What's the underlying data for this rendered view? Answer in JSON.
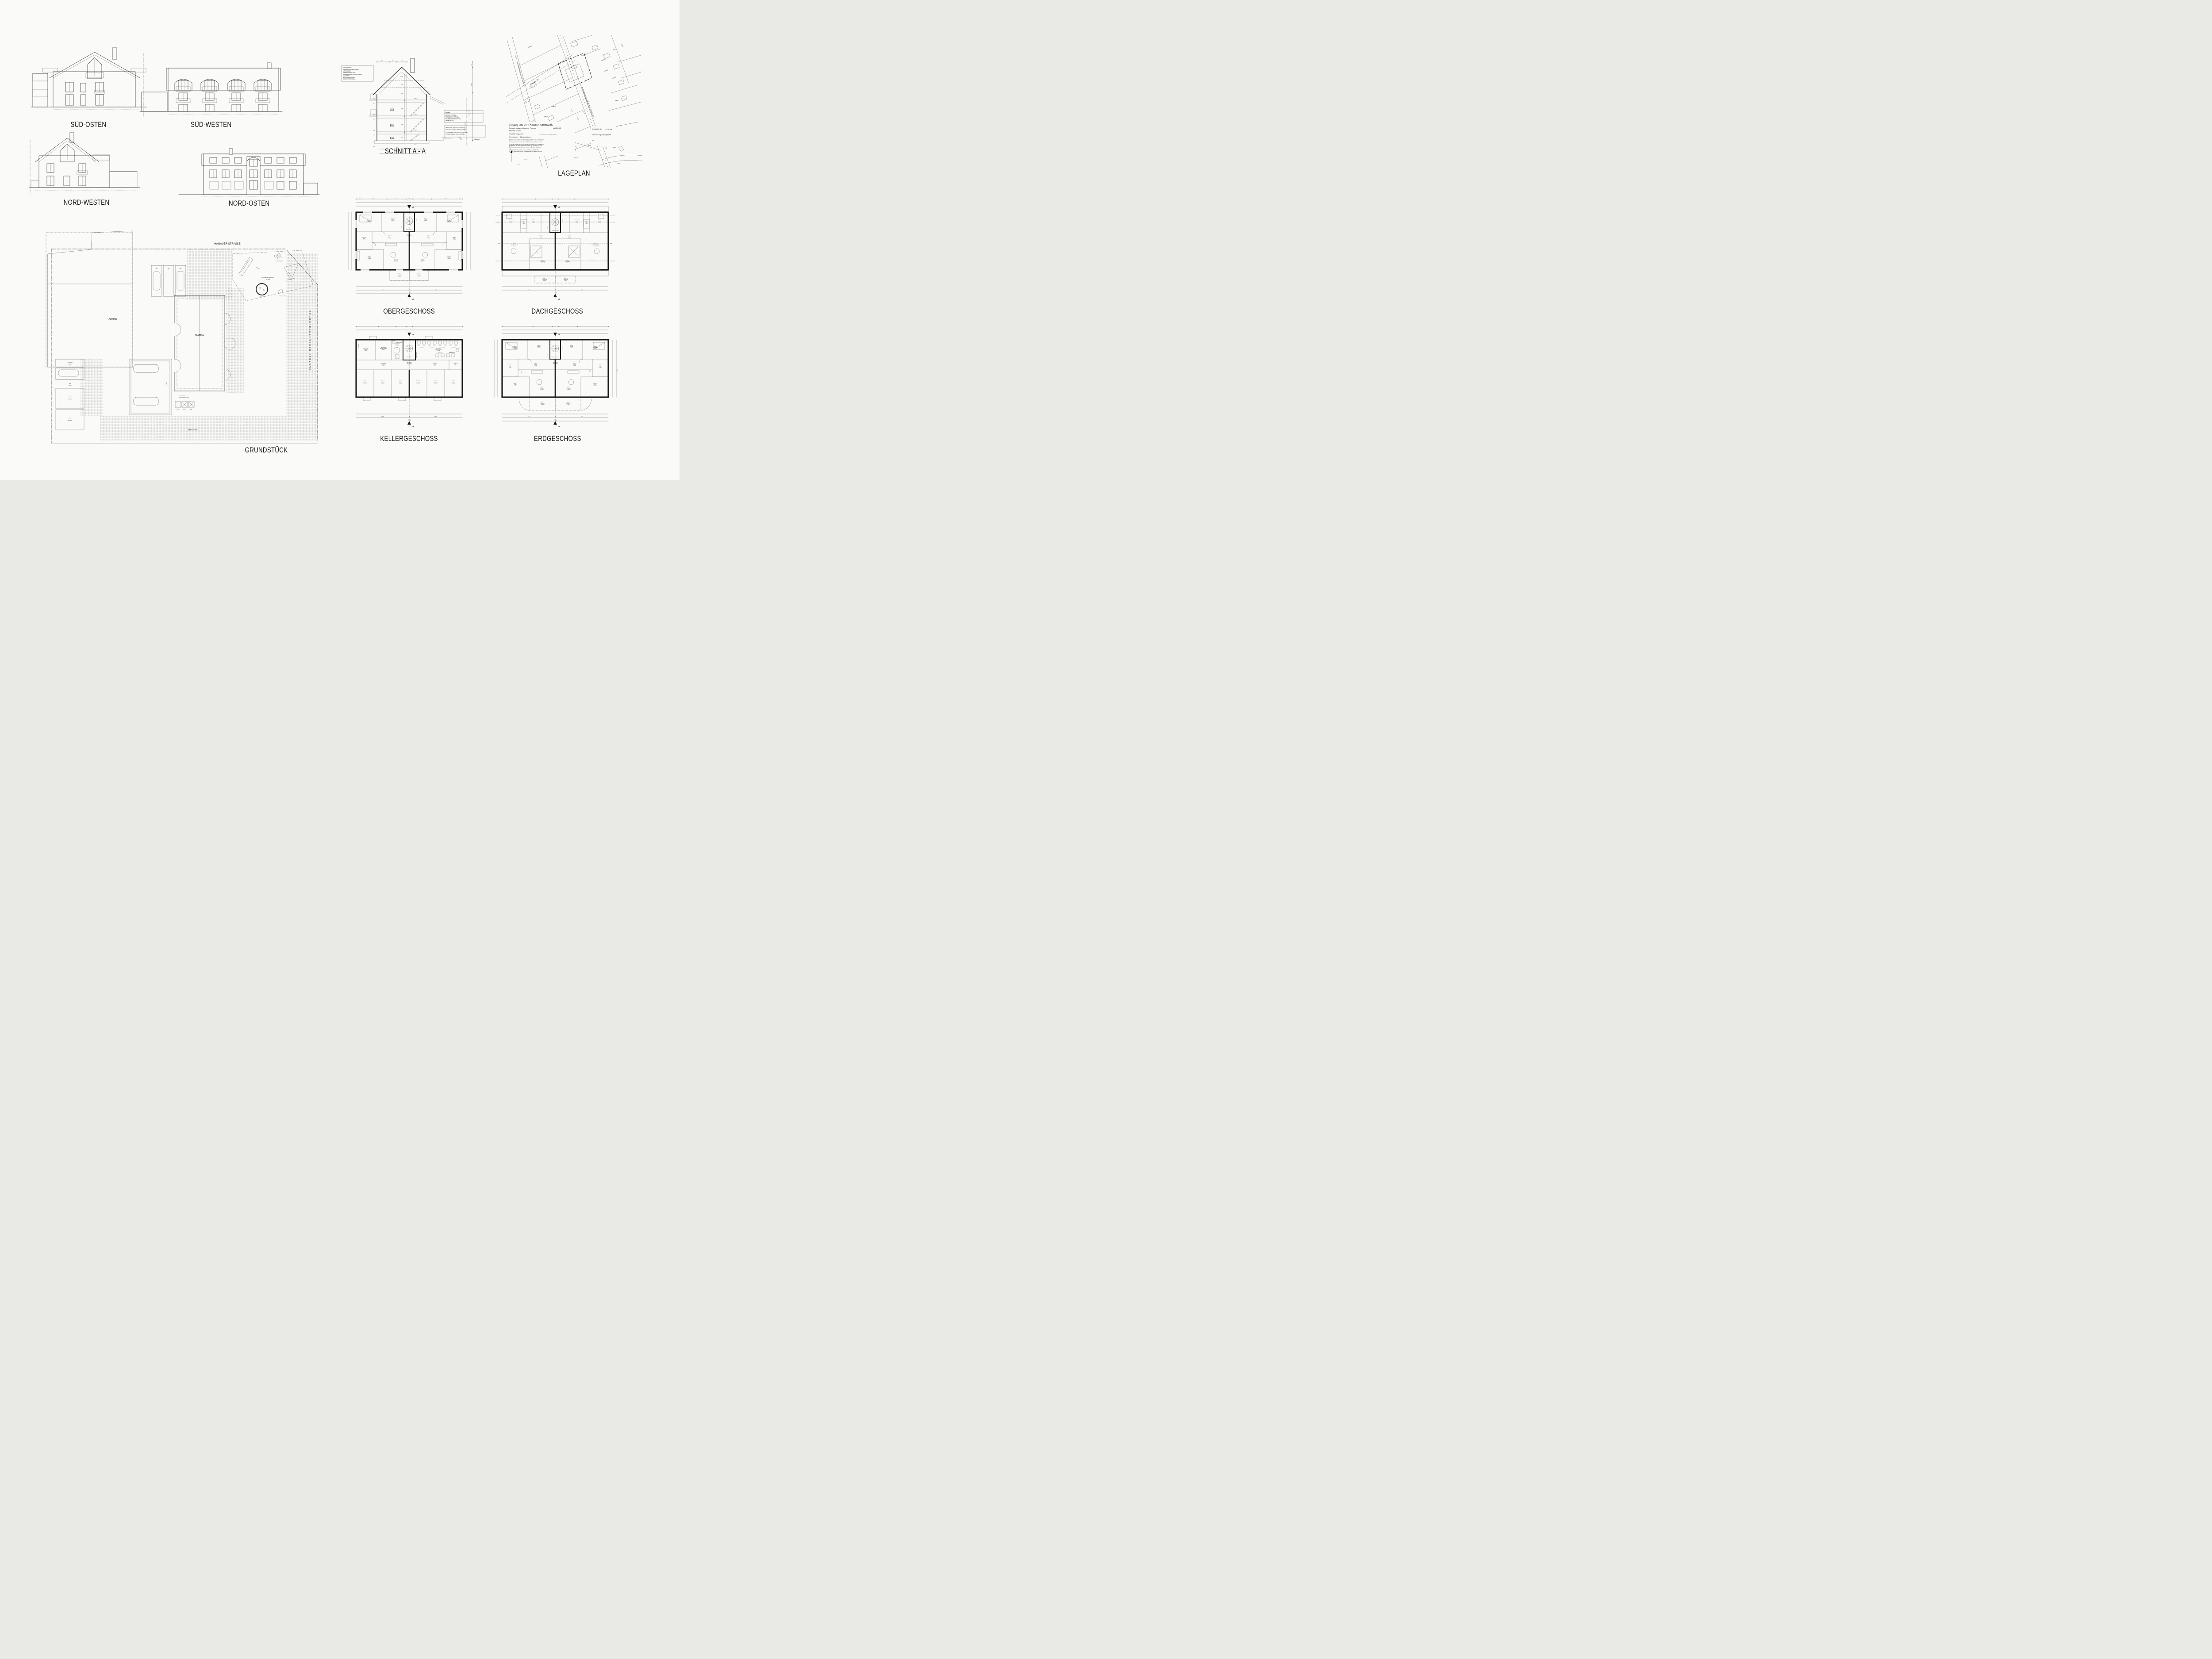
{
  "sheet": {
    "background": "#fafaf8",
    "ink": "#1d1d1d"
  },
  "elevations": {
    "sued_osten": {
      "label": "SÜD-OSTEN"
    },
    "sued_westen": {
      "label": "SÜD-WESTEN"
    },
    "nord_westen": {
      "label": "NORD-WESTEN"
    },
    "nord_osten": {
      "label": "NORD-OSTEN"
    }
  },
  "section": {
    "caption": "SCHNITT A - A",
    "floor_labels": [
      "OG",
      "EG",
      "KG"
    ],
    "dachaufbau": {
      "title": "DACHAUFBAU:",
      "lines": [
        "FLACHDACHSTEINE NATURROT",
        "LATTUNG 30/50",
        "KONTERLATTUNG 40/60",
        "WÄRMEDÄMMUNG - PUR 025 140 mm",
        "DACHPAPPE",
        "SICHTSCHALUNG 24cm",
        "SICHTSPARREN 10/18cm"
      ]
    },
    "boden": {
      "title": "BODEN:",
      "lines": [
        "ESTRICH ZE 30.5cm",
        "STB-BODENPLATTE 25cm",
        "SAUBERKEITSSCHICHT 5cm",
        "KIESBETT 25cm"
      ]
    },
    "statik": {
      "lines": [
        "SÄMTLICHE TRAGENDEN BAUTEILE",
        "NACH STATISCHEN BERECHNUNGEN!"
      ],
      "lines2": [
        "FUNDAMENTE AUF TRAGFÄHIGEN UND",
        "FROSTSICHEREN GRUND SETZEN!"
      ]
    },
    "levels_left": [
      "+5.45",
      "+5.25",
      "+2.65",
      "+2.45",
      "-0.15",
      "-0.35",
      "-2.72",
      "-2.87"
    ],
    "levels_right": [
      "+5.60",
      "+2.80",
      "±0.00",
      "-2.62"
    ],
    "levels_bottom": [
      "-3.03",
      "-3.52"
    ],
    "top_dims": [
      "97.5",
      "93",
      "1.73"
    ],
    "roof_dims": [
      "1.5342",
      "1.00",
      "1.00"
    ],
    "storey_dims": [
      "2.45",
      "2.45",
      "2.25"
    ],
    "right_dims": {
      "d50": "50",
      "d31725": "3.1725",
      "d627": "6.27",
      "traufe": "TRAUF-HÖHE",
      "grenze": "GRUNDSTÜCKSGRENZE",
      "gehweg": "GEHWEG",
      "p033": "+0.33",
      "stg": "2 STG. 17/35"
    }
  },
  "lageplan": {
    "caption": "LAGEPLAN",
    "title": "Auszug aus dem Katasterkartenwerk",
    "sub1": "Flurkarte /Ausschnitt aus der Flurkarte",
    "sub1b": "NW 29 -6.5",
    "sub2": "Maßstab 1:1000",
    "sub3": "Vergrößerung aus 1:",
    "sub3b": "(zur Maßentnahme nur bedingt geeignet)",
    "sub4a": "Gemarkung",
    "sub4b": "Unsernherrn",
    "fine1": [
      "Die Erstellung von Auszügen aus dem Katasterkartenwerk ist der das Kataster führenden",
      "Behörde vorbehalten (Art. 11 Abs. 4 VermKatG). Vervielfältigungen (kopiert bzw. digitalisiert",
      "und EDV-gespeichert) nur für den eigenen Bedarf. Weitergabe an Dritte nicht erlaubt."
    ],
    "fine2": [
      "In der Darstelung der Grenzen können Veränderungen berücksichtigt",
      "sichtigt sein, die noch nicht in das Grundbuch übernommen sind.",
      "Der Gebäudenachweis kann vom örtlichen Bestand abweichen."
    ],
    "fine3": [
      "Lang gestrichelte Grenzen sind aus Flurkarte 1:5000 oder",
      "1 : 2500 übertragen und zur Maßentnahme nur bedingt geeignet."
    ],
    "right1a": "Ingolstadt, den",
    "right1b": "10.2.98",
    "right2": "Vermessungsamt Ingolstadt",
    "right3": "i.A.",
    "north": "N",
    "streets": {
      "main": "Schrobenhausener Str. (Kr IN 14)",
      "hagauer": "Hagauer Str.",
      "oberring": "Oberringstr."
    },
    "parcels": [
      "5299/52",
      "5299/53",
      "5846/2",
      "5846/3",
      "5846/10",
      "5846/20",
      "5846/22",
      "5846/26",
      "1249",
      "1167/12",
      "1167/8",
      "1167/5",
      "1167/6",
      "1167/13",
      "1167/20",
      "1167/19",
      "1167/18",
      "1167/14",
      "1167/21",
      "1167/15",
      "1167/10",
      "1167/11",
      "1155/1",
      "1155/4",
      "1155/2",
      "1153",
      "1156/3",
      "1154/2",
      "1167/31",
      "1167/30",
      "1167",
      "1167/16"
    ]
  },
  "grundstueck": {
    "caption": "GRUNDSTÜCK",
    "street_top": "HAGAUER STRASSE",
    "street_right": "SCHROBENHAUSENER  STRASSE",
    "einfahrt": "EINFAHRT",
    "altbau": "ALTBAU",
    "neubau": "NEUBAU",
    "garages": [
      "GA1",
      "GA2",
      "GA3"
    ],
    "schuppen": [
      "SCHUPPEN",
      "8.76m²"
    ],
    "ga4": [
      "GA4",
      "16.33m²"
    ],
    "ga5": [
      "GA5",
      "BESTAND"
    ],
    "ga6": [
      "GA6",
      "BESTAND"
    ],
    "muell": "MÜLL",
    "stellplatz": "STPL.",
    "flurnummer": [
      "FLURNUMMER:",
      "TEILFLÄCHE AUS 1167/4"
    ],
    "playground": {
      "title": "KINDERSPIELPLATZ",
      "area": "ca. 60m²",
      "rutsche": "RUTSCHE",
      "sandkasten": "SANDKASTEN",
      "schaukel": "SCHAUKEL",
      "wipp": "WIPP KLEEBLATT",
      "schnecke": "WIPPSCHNECKE"
    }
  },
  "plans": {
    "og": {
      "caption": "OBERGESCHOSS",
      "stairs": "18.7/26.5  15 STG.",
      "marker": "A",
      "tags": [
        "WHG.3",
        "WHG.4"
      ],
      "rooms": [
        {
          "w": "WHG. III",
          "n": "SCHLAFEN",
          "a": "14.60m²"
        },
        {
          "w": "WHG. III",
          "n": "KÜCHE",
          "a": "11.32m²"
        },
        {
          "w": "ALLGEMEIN",
          "n": "TREPPENHAUS",
          "a": "6.78m²"
        },
        {
          "w": "WHG. III",
          "n": "DIELE",
          "a": "7.22m²"
        },
        {
          "w": "WHG. III",
          "n": "BAD",
          "a": "6.89m²"
        },
        {
          "w": "WHG. III",
          "n": "KIND",
          "a": "14.96m²"
        },
        {
          "w": "WHG. III",
          "n": "WOHNEN",
          "a": "21.00m²"
        },
        {
          "w": "WHG. III",
          "n": "TERRASSE",
          "a": "4.38m²"
        },
        {
          "w": "WHG. IV",
          "n": "KÜCHE",
          "a": "11.32m²"
        },
        {
          "w": "WHG. IV",
          "n": "SCHLAFEN",
          "a": "14.60m²"
        },
        {
          "w": "WHG. IV",
          "n": "DIELE",
          "a": "7.22m²"
        },
        {
          "w": "WHG. IV",
          "n": "BAD",
          "a": "6.89m²"
        },
        {
          "w": "WHG. IV",
          "n": "WOHNEN",
          "a": "21.00m²"
        },
        {
          "w": "WHG. IV",
          "n": "KIND",
          "a": "14.96m²"
        },
        {
          "w": "WHG. IV",
          "n": "TERRASSE",
          "a": "4.38m²"
        }
      ],
      "dims_top": [
        "36.5",
        "7.0725",
        "24",
        "2.635",
        "24",
        "7.0725",
        "36.5"
      ],
      "dims_top2": [
        "36.5",
        "2.635",
        "11.5",
        "4.3225",
        "24",
        "2.635",
        "24",
        "4.3225",
        "11.5",
        "2.635",
        "36.5"
      ],
      "dims_top3": [
        "36.5",
        "3.9475",
        "11.5",
        "3.01",
        "24",
        "2.635",
        "24",
        "3.01",
        "11.5",
        "3.9475",
        "36.5"
      ],
      "dims_bottom": [
        "3.82",
        "11.5",
        "4.575",
        "24",
        "4.575",
        "11.5",
        "3.82"
      ],
      "dims_bottom2": [
        "8.51",
        "24",
        "8.51"
      ],
      "total": "17.99"
    },
    "dg": {
      "caption": "DACHGESCHOSS",
      "stairs": "15 STG. 18.5/26.5",
      "marker": "A",
      "tags": [
        "WHG.5",
        "WHG.6"
      ],
      "notes": [
        "1.00 M HOCH",
        "2.00 M HOCH",
        "FIRST"
      ],
      "rooms": [
        {
          "w": "WHG. V",
          "n": "KÜCHE",
          "a": "9.33m²"
        },
        {
          "w": "WHG. V",
          "n": "BAD",
          "a": "6.63m²"
        },
        {
          "w": "WHG. V",
          "n": "A.R.",
          "a": "1.53m²"
        },
        {
          "w": "WHG. V",
          "n": "DIELE",
          "a": "5.31m²"
        },
        {
          "w": "WHG. V",
          "n": "WOHNEN/ESSEN",
          "a": "22.08m²"
        },
        {
          "w": "WHG. V",
          "n": "SCHLAFEN",
          "a": "16.95m²"
        },
        {
          "w": "WHG. V",
          "n": "TERRASSE",
          "a": "3.32m²"
        },
        {
          "w": "WHG. VI",
          "n": "KÜCHE",
          "a": "9.33m²"
        },
        {
          "w": "WHG. VI",
          "n": "BAD",
          "a": "6.63m²"
        },
        {
          "w": "WHG. VI",
          "n": "A.R.",
          "a": "1.53m²"
        },
        {
          "w": "WHG. VI",
          "n": "DIELE",
          "a": "5.31m²"
        },
        {
          "w": "WHG. VI",
          "n": "WOHNEN/ESSEN",
          "a": "22.08m²"
        },
        {
          "w": "WHG. VI",
          "n": "SCHLAFEN",
          "a": "16.95m²"
        },
        {
          "w": "WHG. VI",
          "n": "TERRASSE",
          "a": "3.32m²"
        }
      ],
      "dims_top": [
        "36.5",
        "3.948",
        "11.5",
        "1.885",
        "1.125",
        "24",
        "2.635",
        "24",
        "1.365",
        "1.885",
        "11.5",
        "3.948",
        "36.5"
      ],
      "dims_bottom": [
        "3.948",
        "11.5",
        "1.07",
        "11.5",
        "3.26",
        "24",
        "3.28",
        "11.5",
        "1.07",
        "11.5",
        "3.948"
      ],
      "dims_bottom2": [
        "8.51",
        "24",
        "8.51"
      ],
      "total": "17.99"
    },
    "kg": {
      "caption": "KELLERGESCHOSS",
      "stairs": "14 STG. 18.5/26.5",
      "marker": "A",
      "aqualift": "AQUALIFT 40/40cm",
      "luftung": "LÜFTUNG",
      "trocken": "TROCKENBEREICH",
      "appliances": [
        "WM",
        "WT"
      ],
      "wohnung_tags": [
        "WOHNUNG I",
        "WOHNUNG II",
        "WOHNUNG III",
        "WOHNUNG IV",
        "WOHNUNG V",
        "WOHNUNG VI"
      ],
      "rooms": [
        {
          "w": "VERMIETER",
          "n": "KELLER",
          "a": "9.14m²"
        },
        {
          "w": "ALLGEMEIN",
          "n": "ANSCHLUSSRAUM",
          "a": "8.64m²"
        },
        {
          "w": "ALLGEMEIN",
          "n": "HEIZUNG",
          "a": "11.61m²"
        },
        {
          "w": "ALLGEMEIN",
          "n": "TREPPENHAUS",
          "a": "9.30m²"
        },
        {
          "w": "ALLGEMEIN",
          "n": "WASCHKÜCHE",
          "a": "27.30m²"
        },
        {
          "w": "ALLGEMEIN",
          "n": "FLUR I",
          "a": "9.14m²"
        },
        {
          "w": "ALLGEMEIN",
          "n": "FLUR II",
          "a": "9.04m²"
        },
        {
          "w": "VERMIETER",
          "n": "A.R.",
          "a": "2.48m²"
        },
        {
          "w": "WHG. I",
          "n": "KELLER",
          "a": "12.71m²"
        },
        {
          "w": "WHG. III",
          "n": "KELLER",
          "a": "12.71m²"
        },
        {
          "w": "WHG. V",
          "n": "KELLER",
          "a": "12.71m²"
        },
        {
          "w": "WHG. VI",
          "n": "KELLER",
          "a": "12.71m²"
        },
        {
          "w": "WHG. IV",
          "n": "KELLER",
          "a": "12.71m²"
        },
        {
          "w": "WHG. II",
          "n": "KELLER",
          "a": "12.71m²"
        }
      ],
      "dims_top": [
        "30",
        "1.6375",
        "11.5",
        "3.26",
        "11.5",
        "3.01",
        "24",
        "2.635",
        "24",
        "7.1375",
        "30"
      ],
      "dims_bottom": [
        "2.782",
        "11.5",
        "2.782",
        "11.5",
        "2.781",
        "24",
        "2.781",
        "11.5",
        "2.782",
        "11.5",
        "2.782"
      ],
      "dims_bottom2": [
        "8.575",
        "24",
        "8.575"
      ],
      "total": "17.99"
    },
    "eg": {
      "caption": "ERDGESCHOSS",
      "stairs": "18.7/26.5  15 STG.",
      "marker": "A",
      "tags": [
        "WHG.1",
        "WHG.2"
      ],
      "side_total": "10.99",
      "rooms": [
        {
          "w": "WHG. I",
          "n": "SCHLAFEN",
          "a": "14.60m²"
        },
        {
          "w": "WHG. I",
          "n": "KÜCHE",
          "a": "11.32m²"
        },
        {
          "w": "ALLGEMEIN",
          "n": "TREPPENHAUS",
          "a": "6.78m²"
        },
        {
          "w": "WHG. I",
          "n": "DIELE",
          "a": "7.22m²"
        },
        {
          "w": "WHG. I",
          "n": "BAD",
          "a": "6.89m²"
        },
        {
          "w": "WHG. I",
          "n": "KIND",
          "a": "14.96m²"
        },
        {
          "w": "WHG. I",
          "n": "WOHNEN",
          "a": "21.09m²"
        },
        {
          "w": "WHG. I",
          "n": "TERRASSE",
          "a": "8.31m²"
        },
        {
          "w": "WHG. II",
          "n": "KÜCHE",
          "a": "11.32m²"
        },
        {
          "w": "WHG. II",
          "n": "SCHLAFEN",
          "a": "14.60m²"
        },
        {
          "w": "WHG. II",
          "n": "DIELE",
          "a": "7.22m²"
        },
        {
          "w": "WHG. II",
          "n": "BAD",
          "a": "6.89m²"
        },
        {
          "w": "WHG. II",
          "n": "WOHNEN",
          "a": "21.09m²"
        },
        {
          "w": "WHG. II",
          "n": "KIND",
          "a": "14.96m²"
        },
        {
          "w": "WHG. II",
          "n": "TERRASSE",
          "a": "8.31m²"
        }
      ],
      "dims_top": [
        "36.5",
        "2.635",
        "11.5",
        "4.3225",
        "24",
        "2.635",
        "24",
        "4.3225",
        "11.5",
        "2.635",
        "36.5"
      ],
      "dims_bottom": [
        "3.82",
        "11.5",
        "4.575",
        "24",
        "4.575",
        "11.5",
        "3.82"
      ],
      "dims_bottom2": [
        "8.51",
        "24",
        "8.51"
      ],
      "total": "17.99"
    }
  }
}
